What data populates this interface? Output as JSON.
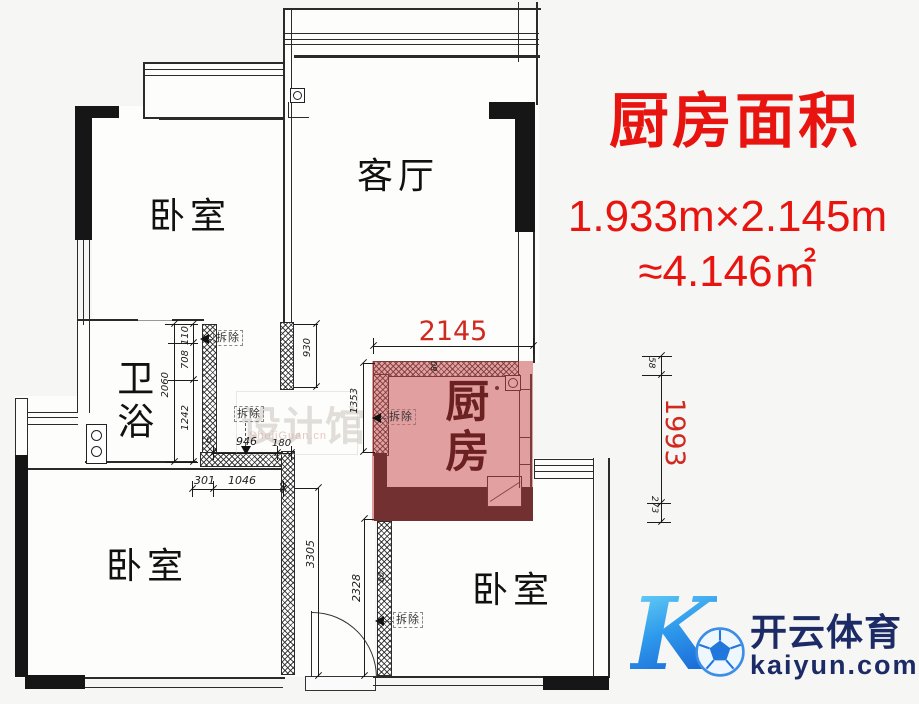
{
  "info_panel": {
    "title": "厨房面积",
    "size_line": "1.933m×2.145m",
    "area_line": "≈4.146㎡"
  },
  "rooms": {
    "bedroom_top_left": "卧室",
    "living_room": "客厅",
    "bathroom": "卫浴",
    "kitchen": "厨房",
    "bedroom_bottom_left": "卧室",
    "bedroom_bottom_right": "卧室"
  },
  "dims": {
    "kitchen_width": "2145",
    "kitchen_height": "1993",
    "d58": "58",
    "d273": "273",
    "d930": "930",
    "d110": "110",
    "d708": "708",
    "d2060": "2060",
    "d1242": "1242",
    "d1353": "1353",
    "d946": "946",
    "d180": "180",
    "d0": "0",
    "d301": "301",
    "d1046": "1046",
    "d3305": "3305",
    "d2328": "2328",
    "d80_top": "80",
    "d50": "50",
    "d80_side": "80"
  },
  "annotations": {
    "demolish": "拆除"
  },
  "watermark": {
    "name": "设计馆",
    "url": "ShejiGuan.cn"
  },
  "logo": {
    "letter": "K",
    "brand": "开云体育",
    "domain": "kaiyun.com"
  },
  "colors": {
    "highlight_red": "#e8140f",
    "dim_red": "#d02a20",
    "kitchen_overlay": "rgba(200,72,72,0.52)",
    "logo_navy": "#1c2b66"
  }
}
